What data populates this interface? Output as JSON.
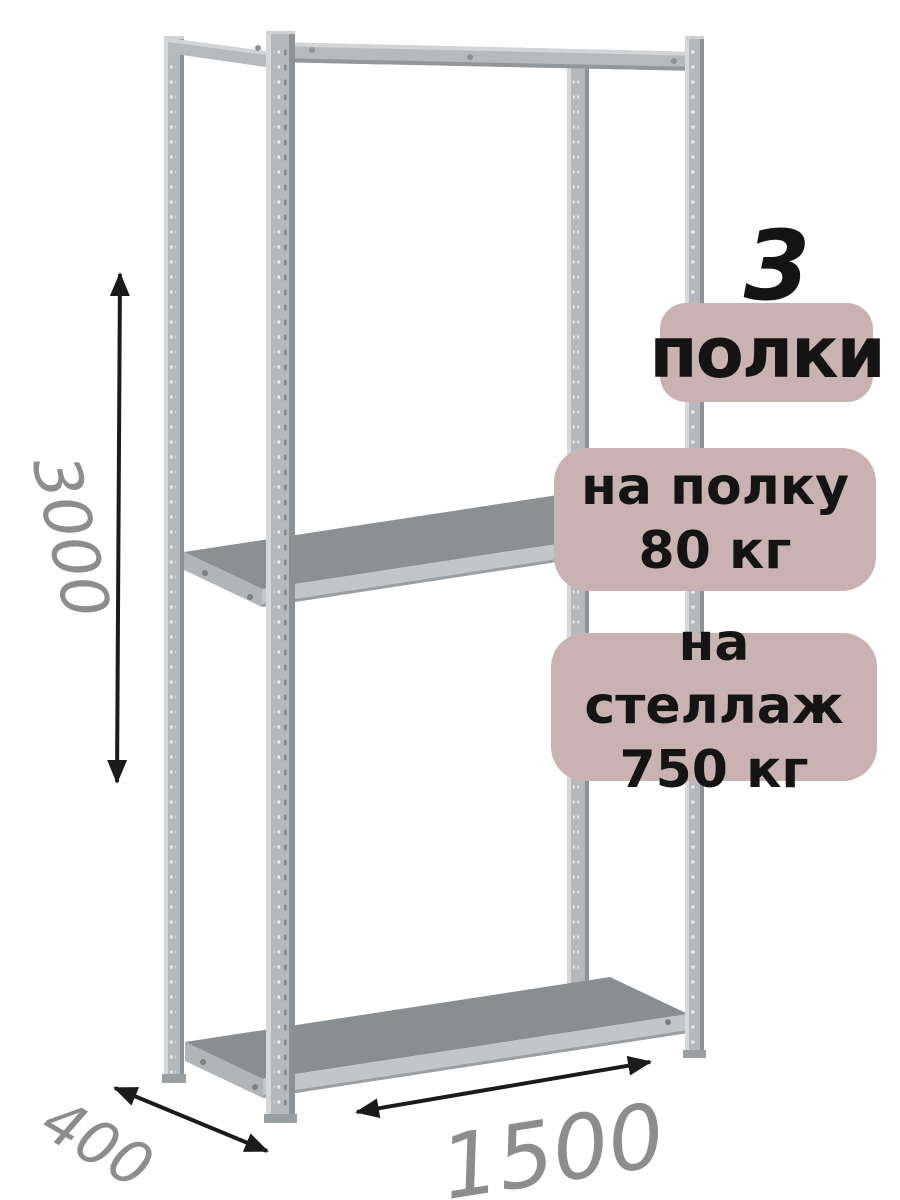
{
  "illustration": {
    "alt": "Metal boltless shelving rack with four perforated posts and three shelves",
    "colors": {
      "metal_base": "#b6b9bb",
      "metal_highlight": "#d6d8d9",
      "metal_shadow": "#8e9294",
      "shelf_surface": "#8d9092",
      "shelf_edge": "#c3c6c8"
    }
  },
  "dimensions": {
    "height": "3000",
    "depth": "400",
    "width": "1500",
    "label_color": "#8d8d8d",
    "arrow_color": "#1b1b1b"
  },
  "badges": {
    "background": "#cab2b3",
    "text_color": "#141414",
    "shelf_count": {
      "number": "3",
      "label": "полки"
    },
    "shelf_load": {
      "line1": "на полку",
      "line2": "80 кг"
    },
    "rack_load": {
      "line1": "на стеллаж",
      "line2": "750 кг"
    }
  }
}
